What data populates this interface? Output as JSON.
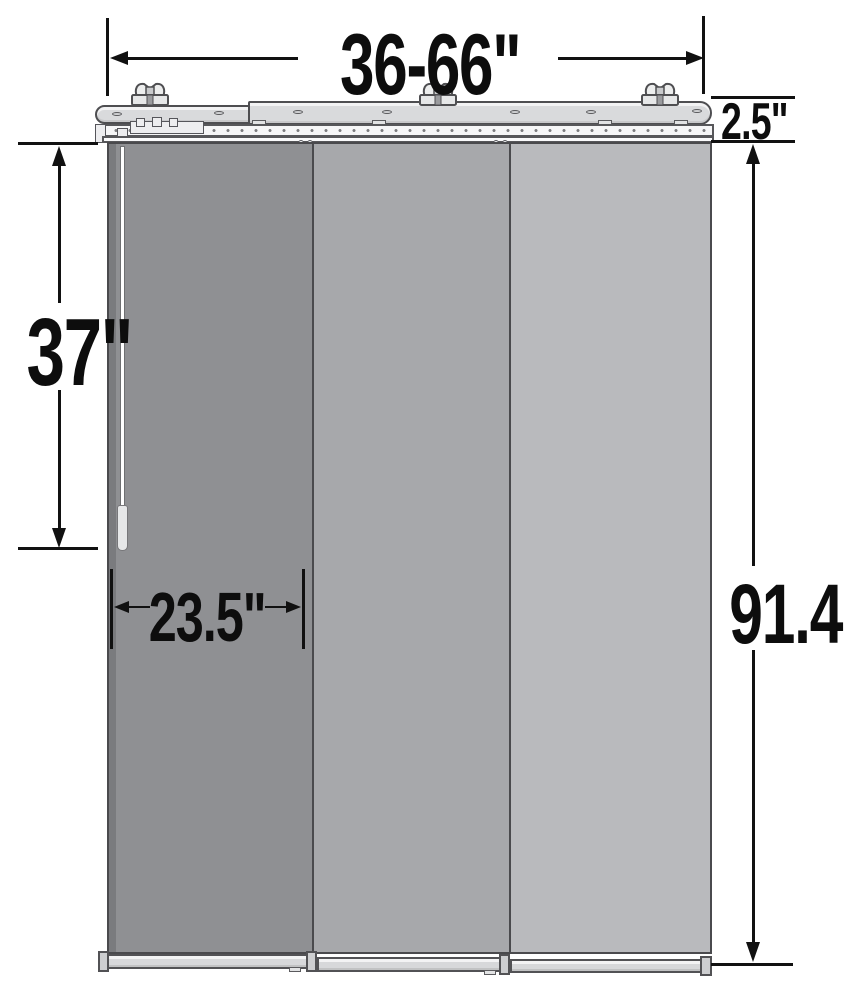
{
  "title": "Panel track blind dimension diagram",
  "dimensions": {
    "width_range": "36-66\"",
    "headrail_height": "2.5\"",
    "wand_length": "37\"",
    "panel_width": "23.5\"",
    "overall_height": "91.4\""
  },
  "colors": {
    "panel_left": "#8F9093",
    "panel_middle": "#A7A8AB",
    "panel_right": "#B9BABD",
    "headrail": "#D9DADC",
    "track": "#F6F6F7",
    "bottom_rail": "#D7D8DA",
    "end_cap": "#CDCED0",
    "wand": "#FFFFFF",
    "wand_handle": "#E6E7E8",
    "dimension_line": "#111111"
  },
  "parts": {
    "headrail": "telescoping-headrail",
    "mounting_brackets": 3,
    "panels": 3,
    "wand": "control-wand",
    "bottom_rails": 3
  }
}
